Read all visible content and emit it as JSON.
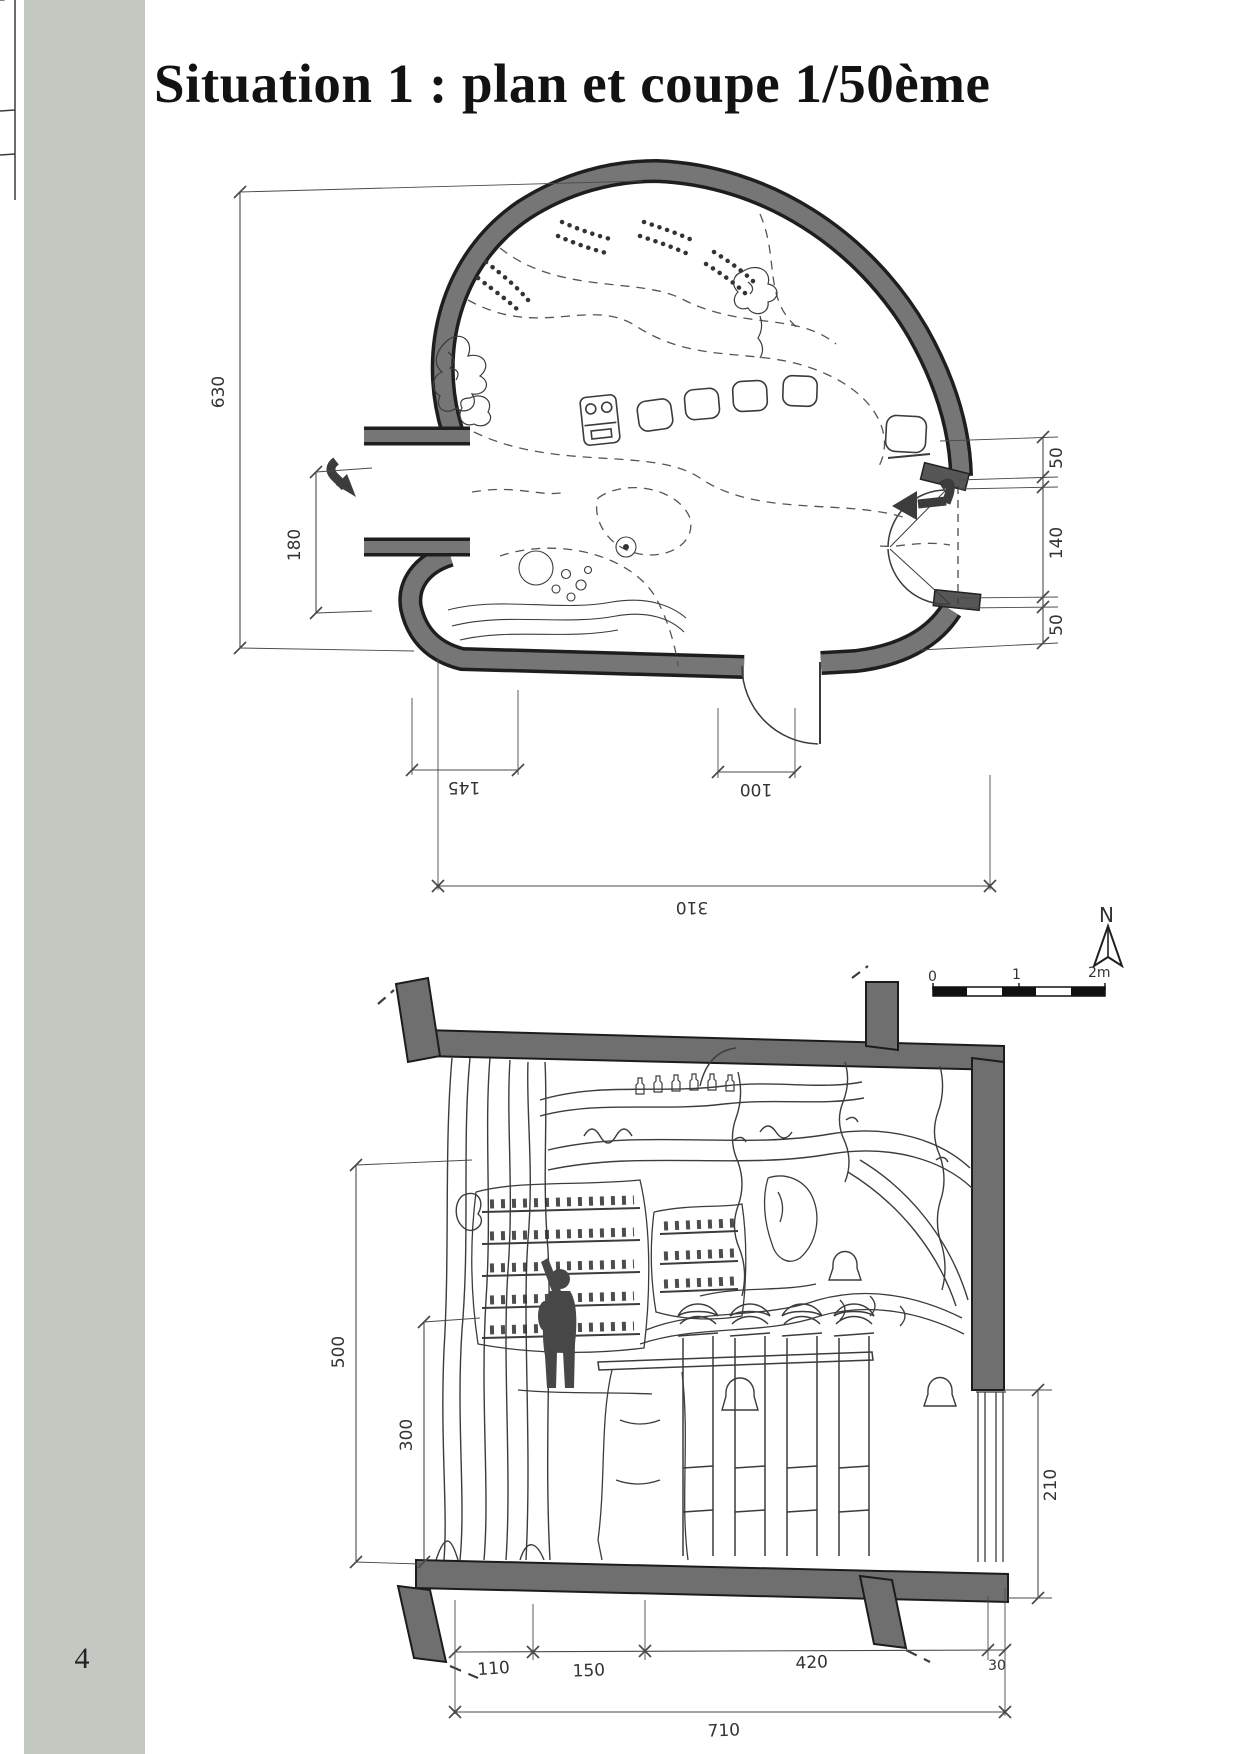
{
  "page": {
    "number": "4",
    "title": "Situation 1 : plan et coupe 1/50ème"
  },
  "colors": {
    "strip": "#c3c9c1",
    "ink": "#3b3b3b",
    "wall_fill": "#757575",
    "figure_fill": "#474747"
  },
  "plan": {
    "north_label": "N",
    "scale_bar": {
      "zero": "0",
      "one": "1",
      "two": "2m"
    },
    "dims": {
      "height_total": "630",
      "entrance_left": "180",
      "right_top": "50",
      "right_middle": "140",
      "right_bottom": "50",
      "bottom_left": "145",
      "bottom_door": "100",
      "bottom_total": "310"
    }
  },
  "section": {
    "dims": {
      "height_interior": "500",
      "height_shelves": "300",
      "right_opening": "210",
      "seg_1": "110",
      "seg_2": "150",
      "seg_3": "420",
      "seg_4": "30",
      "width_total": "710"
    }
  }
}
